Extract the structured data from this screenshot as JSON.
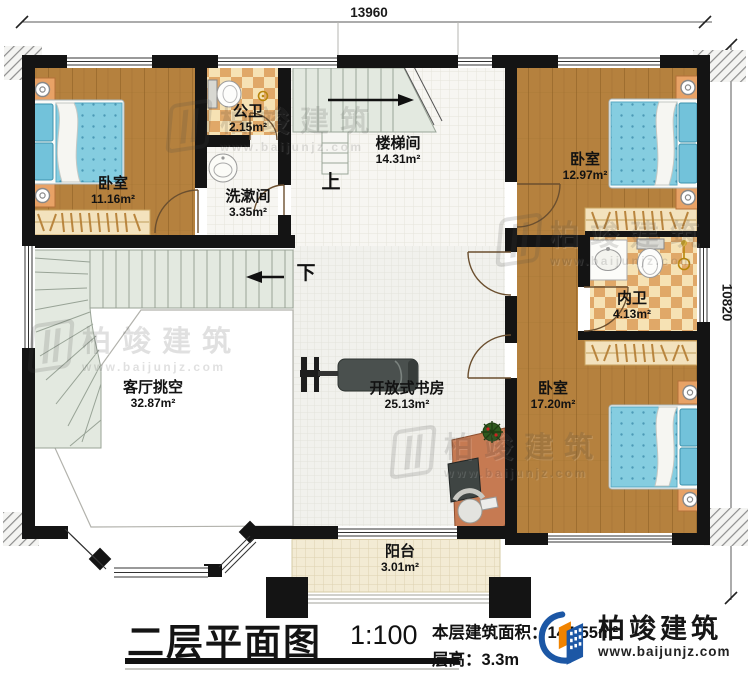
{
  "dimensions": {
    "top": "13960",
    "right": "10820"
  },
  "rooms": [
    {
      "id": "bedroom-1",
      "name": "卧室",
      "area": "11.16m²"
    },
    {
      "id": "public-bath",
      "name": "公卫",
      "area": "2.15m²"
    },
    {
      "id": "washroom",
      "name": "洗漱间",
      "area": "3.35m²"
    },
    {
      "id": "stairwell",
      "name": "楼梯间",
      "area": "14.31m²"
    },
    {
      "id": "bedroom-2",
      "name": "卧室",
      "area": "12.97m²"
    },
    {
      "id": "ensuite-bath",
      "name": "内卫",
      "area": "4.13m²"
    },
    {
      "id": "bedroom-3",
      "name": "卧室",
      "area": "17.20m²"
    },
    {
      "id": "living-void",
      "name": "客厅挑空",
      "area": "32.87m²"
    },
    {
      "id": "open-study",
      "name": "开放式书房",
      "area": "25.13m²"
    },
    {
      "id": "balcony",
      "name": "阳台",
      "area": "3.01m²"
    }
  ],
  "stairs": {
    "up": "上",
    "down": "下"
  },
  "title_block": {
    "title": "二层平面图",
    "scale": "1:100",
    "floor_area_label": "本层建筑面积：",
    "floor_area_value": "144.55m²",
    "storey_height_label": "层高：",
    "storey_height_value": "3.3m"
  },
  "brand": {
    "name": "柏竣建筑",
    "url": "www.baijunjz.com"
  },
  "watermark": {
    "name": "柏竣建筑",
    "url": "www.baijunjz.com"
  },
  "colors": {
    "wall": "#141414",
    "wood_floor": "#b5813e",
    "bath_tile_light": "#f6e2b4",
    "bath_tile_dark": "#e0a868",
    "stair_tread": "#e3e9e0",
    "study_floor": "#f0f0ec",
    "balcony_floor": "#f3ebd4",
    "bed_blue": "#85cde0",
    "furniture_orange": "#e8a266",
    "logo_blue": "#1c57a5",
    "logo_orange": "#f08300"
  }
}
